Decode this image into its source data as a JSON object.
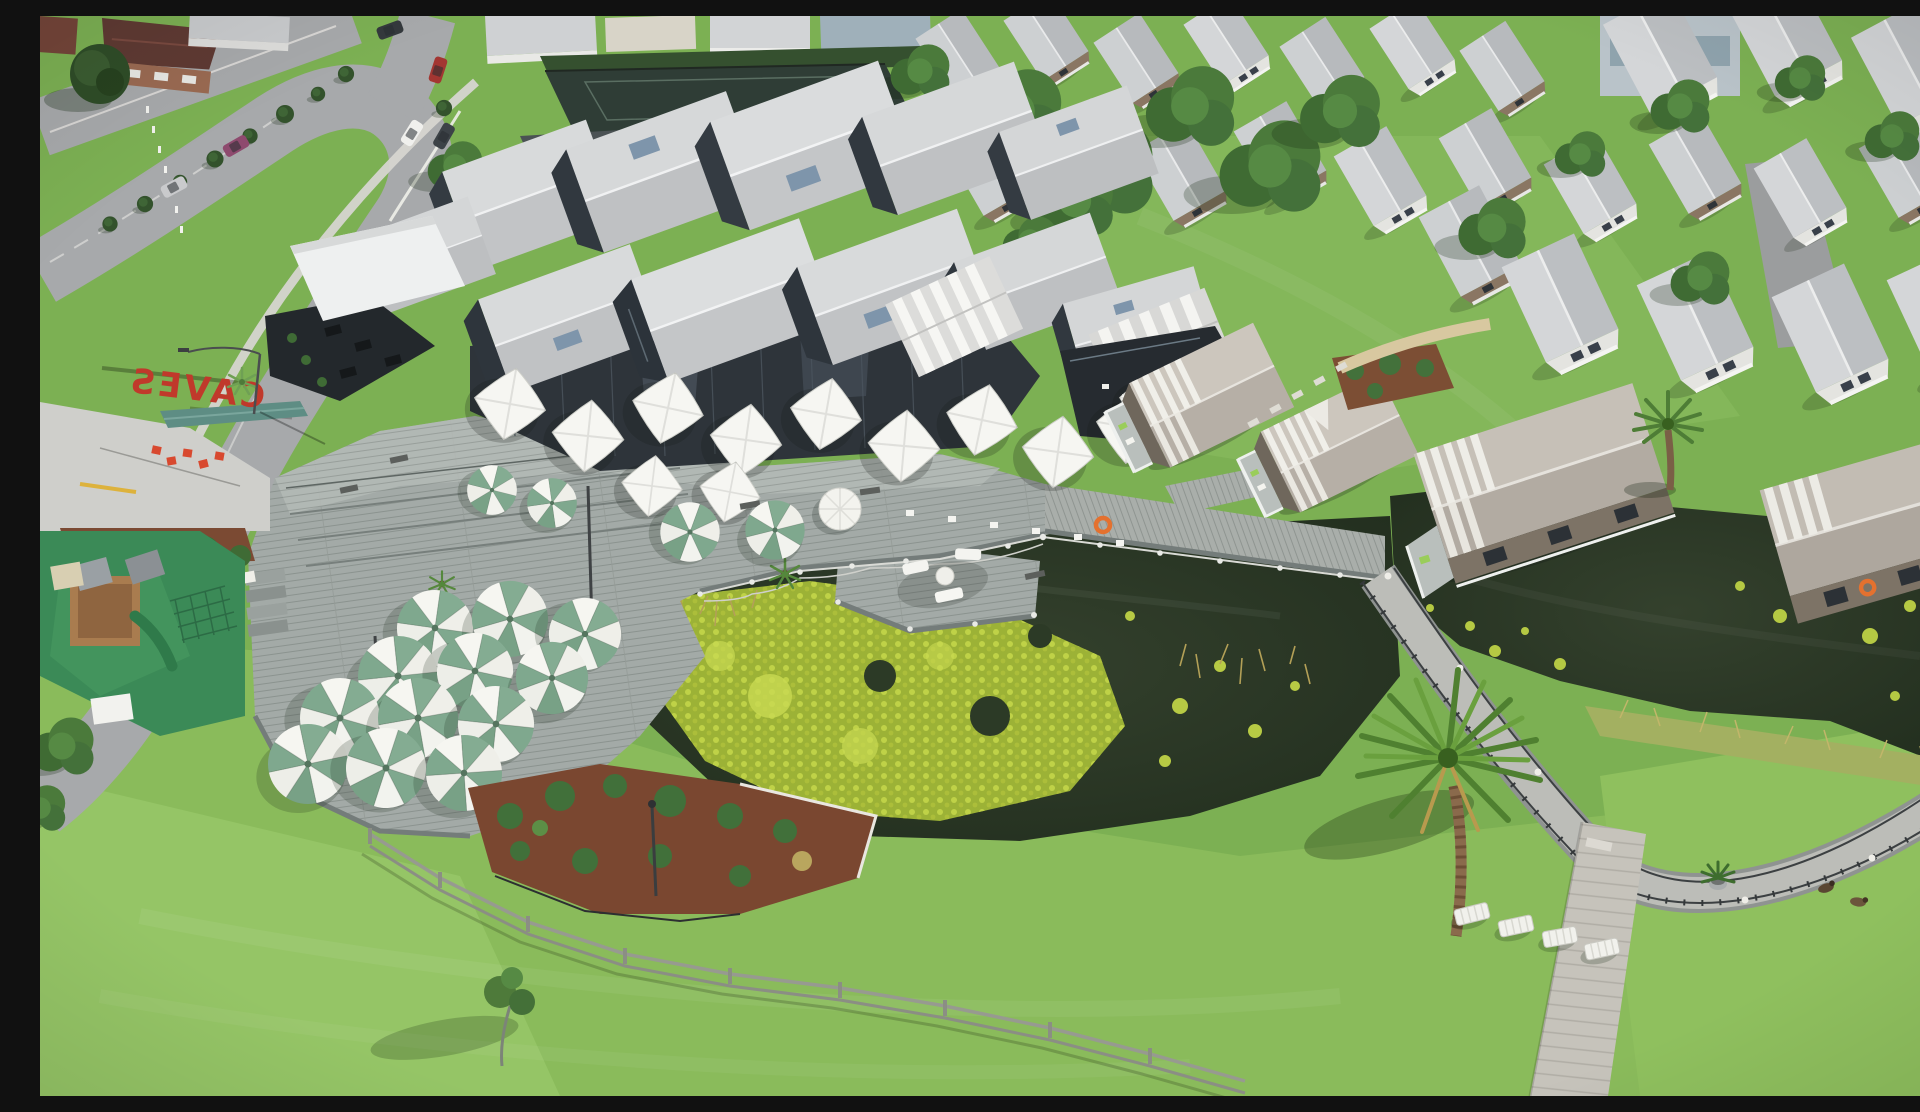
{
  "scene": {
    "type": "aerial-drone-photograph",
    "description": "Aerial drone view of a beachside resort: a large grey multi-gabled pavilion with glass walls, white tensile shade sails and green-and-white cafe umbrellas on weathered timber decks; a dark lagoon partly covered in bright lily pads, crossed by timber boardwalks with rope railings; over-water cottages with stripe-banded roofs; rows of grey-roofed holiday houses behind; a suburban street with parked cars, a red mirrored rooftop sign reading CAVES, a playground, lawns, a tall palm tree, white sun loungers and two ducks.",
    "sign": {
      "text": "CAVES",
      "color": "#c0392b"
    }
  },
  "palette": {
    "grass": "#7cb053",
    "grass_light": "#92c263",
    "road": "#a7a9ab",
    "deck": "#9ba3a0",
    "roof_light": "#d6d8da",
    "roof_mid": "#bfc2c4",
    "glass": "#30373e",
    "water": "#273323",
    "lily": "#b5ca40",
    "umbrella_green": "#7fa88e",
    "umbrella_white": "#f4f4ef",
    "mulch": "#7a4a32",
    "cottage_roof": "#bab3aa",
    "playground": "#3b8a57",
    "sign_red": "#c0392b",
    "life_ring": "#e66a2c",
    "fence_timber": "#8f9187"
  },
  "inventory": {
    "green_white_umbrellas": 16,
    "white_shade_sails": 12,
    "round_white_umbrellas": 1,
    "sun_loungers": 4,
    "ducks": 2,
    "parked_cars": 7,
    "overwater_cottages": 4,
    "ponds": 2,
    "boardwalks": 3,
    "playground": 1,
    "tennis_court": 1,
    "life_rings": 2,
    "palm_trees": 3
  }
}
